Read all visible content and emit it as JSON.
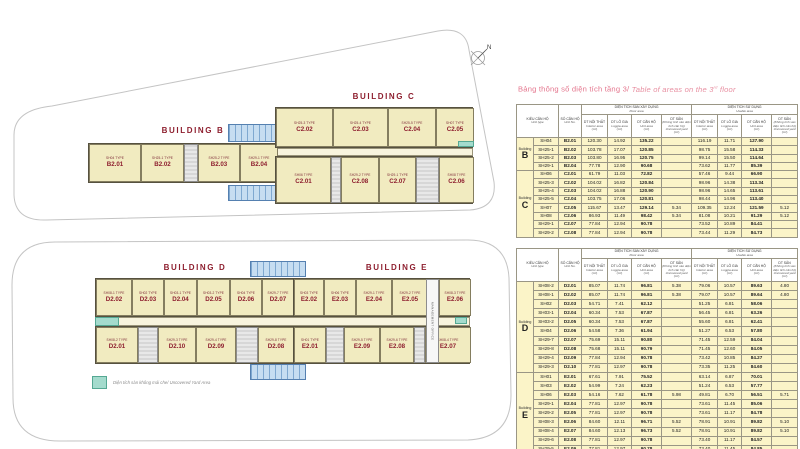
{
  "title": {
    "vi": "Bảng thông số diện tích tầng 3/",
    "en_pre": " Table of areas on the 3",
    "en_sup": "rd",
    "en_post": " floor"
  },
  "compass_label": "N",
  "top_plan": {
    "buildings": [
      {
        "name": "BUILDING B",
        "rows": [
          [
            {
              "type_label": "SH04 TYPE",
              "code": "B2.01"
            },
            {
              "type_label": "SH25-1 TYPE",
              "code": "B2.02"
            },
            {
              "type_label": "SH25-2 TYPE",
              "code": "B2.03"
            },
            {
              "type_label": "SH29-1 TYPE",
              "code": "B2.04"
            }
          ]
        ]
      },
      {
        "name": "BUILDING C",
        "rows": [
          [
            {
              "type_label": "SH25-3 TYPE",
              "code": "C2.02"
            },
            {
              "type_label": "SH25-4 TYPE",
              "code": "C2.03"
            },
            {
              "type_label": "SH25-5 TYPE",
              "code": "C2.04"
            },
            {
              "type_label": "SH07 TYPE",
              "code": "C2.05"
            }
          ],
          [
            {
              "type_label": "SH06 TYPE",
              "code": "C2.01"
            },
            {
              "type_label": "SH29-2 TYPE",
              "code": "C2.08"
            },
            {
              "type_label": "SH29-1 TYPE",
              "code": "C2.07"
            },
            {
              "type_label": "SH08 TYPE",
              "code": "C2.06"
            }
          ]
        ]
      }
    ]
  },
  "bottom_plan": {
    "buildings": [
      {
        "name": "BUILDING D",
        "rows": [
          [
            {
              "type_label": "SH08-1 TYPE",
              "code": "D2.02"
            },
            {
              "type_label": "SH02 TYPE",
              "code": "D2.03"
            },
            {
              "type_label": "SH03-1 TYPE",
              "code": "D2.04"
            },
            {
              "type_label": "SH03-2 TYPE",
              "code": "D2.05"
            },
            {
              "type_label": "SH04 TYPE",
              "code": "D2.06"
            },
            {
              "type_label": "SH29-7 TYPE",
              "code": "D2.07"
            }
          ],
          [
            {
              "type_label": "SH08-2 TYPE",
              "code": "D2.01"
            },
            {
              "type_label": "SH29-3 TYPE",
              "code": "D2.10"
            },
            {
              "type_label": "SH29-4 TYPE",
              "code": "D2.09"
            },
            {
              "type_label": "SH29-8 TYPE",
              "code": "D2.08"
            }
          ]
        ]
      },
      {
        "name": "BUILDING E",
        "rows": [
          [
            {
              "type_label": "SH03 TYPE",
              "code": "E2.02"
            },
            {
              "type_label": "SH06 TYPE",
              "code": "E2.03"
            },
            {
              "type_label": "SH29-1 TYPE",
              "code": "E2.04"
            },
            {
              "type_label": "SH29-2 TYPE",
              "code": "E2.05"
            },
            {
              "type_label": "SH08-3 TYPE",
              "code": "E2.06"
            }
          ],
          [
            {
              "type_label": "SH01 TYPE",
              "code": "E2.01"
            },
            {
              "type_label": "SH29-5 TYPE",
              "code": "E2.09"
            },
            {
              "type_label": "SH29-6 TYPE",
              "code": "E2.08"
            },
            {
              "type_label": "SH08-4 TYPE",
              "code": "E2.07"
            }
          ]
        ]
      }
    ],
    "management_label": "MANAGEMENT OFFICE",
    "legend": {
      "label": "Diện tích sàn không mái che/ Uncovered Yard Area",
      "swatch_color": "#a4dbcd"
    }
  },
  "table_header": {
    "unit_type": {
      "vi": "KIỂU CĂN HỘ",
      "en": "Unit type"
    },
    "unit_no": {
      "vi": "SỐ CĂN HỘ",
      "en": "Unit No."
    },
    "group1": {
      "vi": "DIỆN TÍCH SÀN XÂY DỰNG",
      "en": "Floor area"
    },
    "group2": {
      "vi": "DIỆN TÍCH SỬ DỤNG",
      "en": "Usable area"
    },
    "subs": [
      {
        "vi": "DT NỘI THẤT",
        "en": "Interior area",
        "unit": "(m²)"
      },
      {
        "vi": "DT LÔ GIA",
        "en": "Loggia area",
        "unit": "(m²)"
      },
      {
        "vi": "DT CĂN HỘ",
        "en": "Unit area",
        "unit": "(m²)"
      },
      {
        "vi": "DT SÂN",
        "en": "(Không tính vào diện tích căn hộ) Uncovered yard",
        "unit": "(m²)"
      }
    ]
  },
  "tables": [
    {
      "sections": [
        {
          "building": "Building",
          "letter": "B",
          "rows": [
            {
              "sh": "SH04",
              "no": "B2.01",
              "v": [
                "120.30",
                "14.92",
                "135.22",
                "",
                "116.19",
                "11.71",
                "127.90",
                ""
              ]
            },
            {
              "sh": "SH25-1",
              "no": "B2.02",
              "v": [
                "103.78",
                "17.07",
                "120.85",
                "",
                "98.75",
                "15.58",
                "114.33",
                ""
              ]
            },
            {
              "sh": "SH25-2",
              "no": "B2.03",
              "v": [
                "103.80",
                "16.95",
                "120.75",
                "",
                "99.14",
                "15.50",
                "114.64",
                ""
              ]
            },
            {
              "sh": "SH29-1",
              "no": "B2.04",
              "v": [
                "77.78",
                "12.90",
                "90.68",
                "",
                "73.62",
                "11.77",
                "85.39",
                ""
              ]
            }
          ]
        },
        {
          "building": "Building",
          "letter": "C",
          "rows": [
            {
              "sh": "SH06",
              "no": "C2.01",
              "v": [
                "61.79",
                "11.03",
                "72.82",
                "",
                "57.46",
                "9.44",
                "66.90",
                ""
              ]
            },
            {
              "sh": "SH25-3",
              "no": "C2.02",
              "v": [
                "104.02",
                "16.82",
                "120.84",
                "",
                "98.96",
                "14.38",
                "113.34",
                ""
              ]
            },
            {
              "sh": "SH25-4",
              "no": "C2.03",
              "v": [
                "104.02",
                "16.88",
                "120.90",
                "",
                "98.96",
                "14.65",
                "113.61",
                ""
              ]
            },
            {
              "sh": "SH25-5",
              "no": "C2.04",
              "v": [
                "103.75",
                "17.06",
                "120.81",
                "",
                "98.44",
                "14.96",
                "113.40",
                ""
              ]
            },
            {
              "sh": "SH07",
              "no": "C2.05",
              "v": [
                "115.67",
                "13.47",
                "129.14",
                "5.34",
                "109.35",
                "12.24",
                "121.59",
                "5.12"
              ]
            },
            {
              "sh": "SH08",
              "no": "C2.06",
              "v": [
                "86.93",
                "11.49",
                "98.42",
                "5.34",
                "81.08",
                "10.21",
                "91.29",
                "5.12"
              ]
            },
            {
              "sh": "SH29-1",
              "no": "C2.07",
              "v": [
                "77.84",
                "12.94",
                "90.78",
                "",
                "73.52",
                "10.89",
                "84.41",
                ""
              ]
            },
            {
              "sh": "SH29-2",
              "no": "C2.08",
              "v": [
                "77.84",
                "12.94",
                "90.78",
                "",
                "73.44",
                "11.29",
                "84.73",
                ""
              ]
            }
          ]
        }
      ]
    },
    {
      "sections": [
        {
          "building": "Building",
          "letter": "D",
          "rows": [
            {
              "sh": "SH08-2",
              "no": "D2.01",
              "v": [
                "85.07",
                "11.74",
                "96.81",
                "5.38",
                "79.06",
                "10.57",
                "89.63",
                "4.80"
              ]
            },
            {
              "sh": "SH08-1",
              "no": "D2.02",
              "v": [
                "85.07",
                "11.74",
                "96.81",
                "5.38",
                "79.07",
                "10.57",
                "89.64",
                "4.80"
              ]
            },
            {
              "sh": "SH02",
              "no": "D2.03",
              "v": [
                "54.71",
                "7.41",
                "62.12",
                "",
                "51.25",
                "6.81",
                "58.06",
                ""
              ]
            },
            {
              "sh": "SH03-1",
              "no": "D2.04",
              "v": [
                "60.34",
                "7.53",
                "67.87",
                "",
                "56.45",
                "6.81",
                "63.26",
                ""
              ]
            },
            {
              "sh": "SH03-2",
              "no": "D2.05",
              "v": [
                "60.34",
                "7.53",
                "67.87",
                "",
                "55.60",
                "6.81",
                "62.41",
                ""
              ]
            },
            {
              "sh": "SH04",
              "no": "D2.06",
              "v": [
                "54.58",
                "7.36",
                "61.94",
                "",
                "51.27",
                "6.53",
                "57.80",
                ""
              ]
            },
            {
              "sh": "SH29-7",
              "no": "D2.07",
              "v": [
                "75.69",
                "15.11",
                "90.80",
                "",
                "71.45",
                "12.59",
                "84.04",
                ""
              ]
            },
            {
              "sh": "SH29-8",
              "no": "D2.08",
              "v": [
                "75.68",
                "15.11",
                "90.79",
                "",
                "71.45",
                "12.60",
                "84.05",
                ""
              ]
            },
            {
              "sh": "SH29-4",
              "no": "D2.09",
              "v": [
                "77.84",
                "12.94",
                "90.78",
                "",
                "73.42",
                "10.85",
                "84.27",
                ""
              ]
            },
            {
              "sh": "SH29-3",
              "no": "D2.10",
              "v": [
                "77.81",
                "12.97",
                "90.78",
                "",
                "73.35",
                "11.25",
                "84.60",
                ""
              ]
            }
          ]
        },
        {
          "building": "Building",
          "letter": "E",
          "rows": [
            {
              "sh": "SH01",
              "no": "E2.01",
              "v": [
                "67.61",
                "7.91",
                "75.52",
                "",
                "63.14",
                "6.87",
                "70.01",
                ""
              ]
            },
            {
              "sh": "SH03",
              "no": "E2.02",
              "v": [
                "54.99",
                "7.24",
                "62.23",
                "",
                "51.24",
                "6.53",
                "57.77",
                ""
              ]
            },
            {
              "sh": "SH06",
              "no": "E2.03",
              "v": [
                "54.16",
                "7.62",
                "61.78",
                "5.98",
                "49.81",
                "6.70",
                "56.51",
                "5.71"
              ]
            },
            {
              "sh": "SH29-1",
              "no": "E2.04",
              "v": [
                "77.81",
                "12.97",
                "90.78",
                "",
                "73.61",
                "11.45",
                "85.06",
                ""
              ]
            },
            {
              "sh": "SH29-2",
              "no": "E2.05",
              "v": [
                "77.81",
                "12.97",
                "90.78",
                "",
                "73.61",
                "11.17",
                "84.78",
                ""
              ]
            },
            {
              "sh": "SH08-3",
              "no": "E2.06",
              "v": [
                "84.60",
                "12.11",
                "96.71",
                "5.52",
                "78.91",
                "10.91",
                "89.82",
                "5.10"
              ]
            },
            {
              "sh": "SH08-4",
              "no": "E2.07",
              "v": [
                "84.60",
                "12.13",
                "96.73",
                "5.52",
                "78.91",
                "10.91",
                "89.82",
                "5.10"
              ]
            },
            {
              "sh": "SH29-6",
              "no": "E2.08",
              "v": [
                "77.81",
                "12.97",
                "90.78",
                "",
                "73.40",
                "11.17",
                "84.57",
                ""
              ]
            },
            {
              "sh": "SH29-5",
              "no": "E2.09",
              "v": [
                "77.81",
                "12.97",
                "90.78",
                "",
                "73.40",
                "11.45",
                "84.85",
                ""
              ]
            }
          ]
        }
      ]
    }
  ]
}
